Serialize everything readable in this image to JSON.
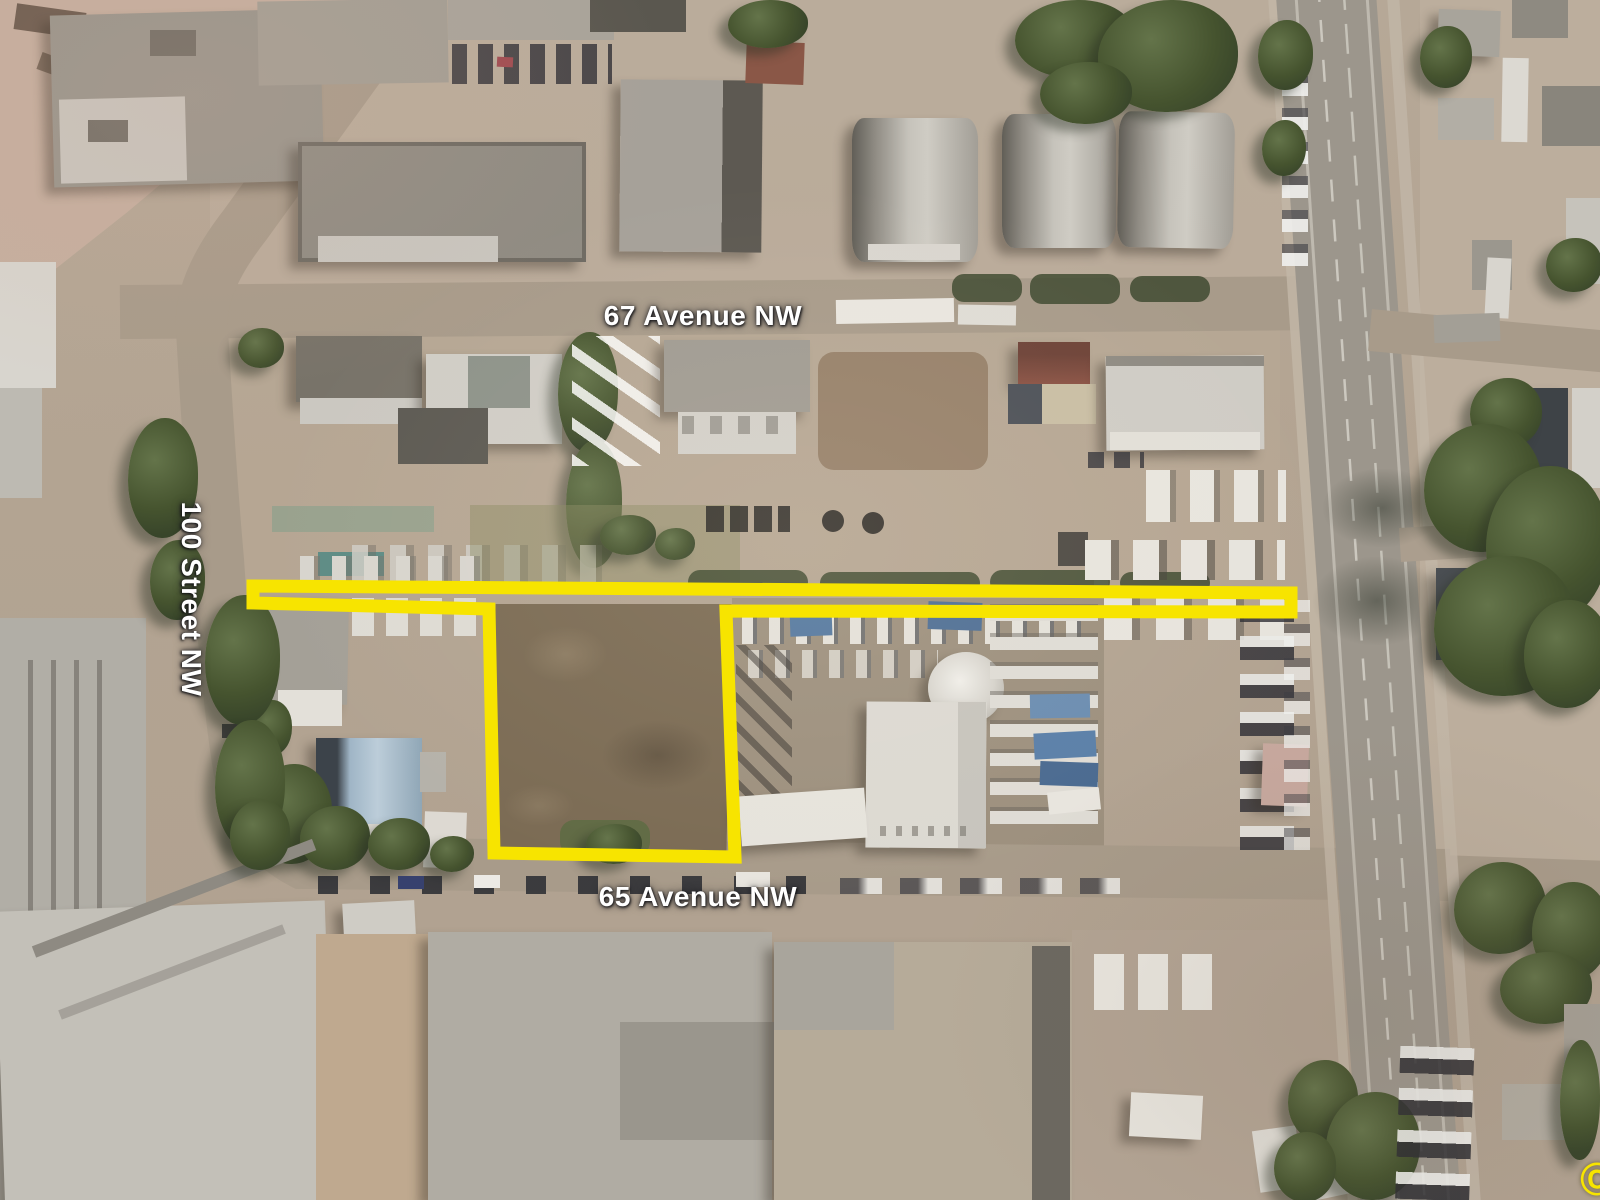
{
  "map": {
    "type": "aerial-photo",
    "labels": {
      "avenue67": "67 Avenue NW",
      "street100": "100 Street NW",
      "avenue65": "65 Avenue NW"
    },
    "label_text_color": "#ffffff",
    "copyright_mark": "©",
    "boundary": {
      "color": "#f7e400",
      "stroke_width": 13,
      "points": "253,586 1291,593 1291,612 726,611 735,857 494,853 489,609 253,603"
    }
  }
}
